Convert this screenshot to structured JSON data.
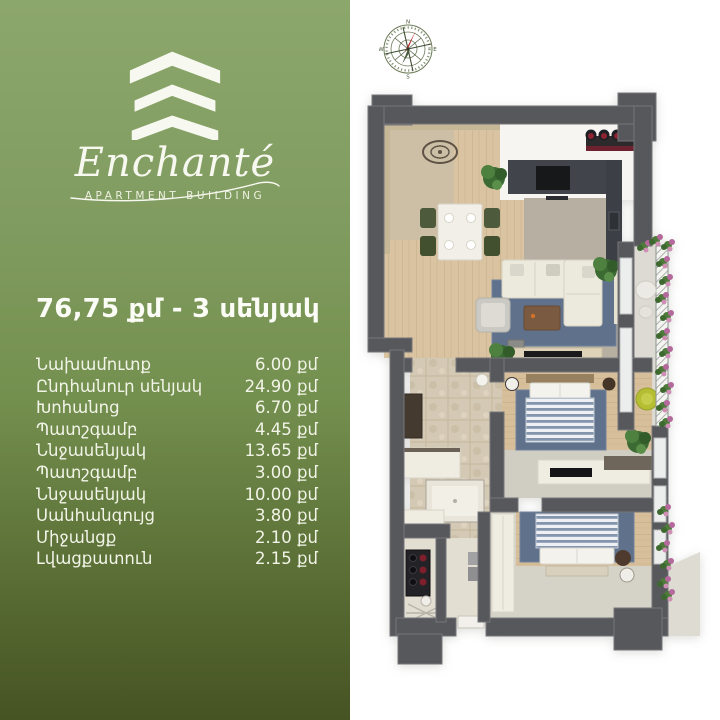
{
  "brand": {
    "name": "Enchanté",
    "tagline": "APARTMENT BUILDING",
    "logo_icon": "building-chevrons-icon"
  },
  "listing": {
    "title": "76,75 քմ - 3 սենյակ",
    "rooms": [
      {
        "label": "Նախամուտք",
        "area": "6.00 քմ"
      },
      {
        "label": "Ընդհանուր սենյակ",
        "area": "24.90 քմ"
      },
      {
        "label": "Խոհանոց",
        "area": "6.70 քմ"
      },
      {
        "label": "Պատշգամբ",
        "area": "4.45 քմ"
      },
      {
        "label": "Ննջասենյակ",
        "area": "13.65 քմ"
      },
      {
        "label": "Պատշգամբ",
        "area": "3.00 քմ"
      },
      {
        "label": "Ննջասենյակ",
        "area": "10.00 քմ"
      },
      {
        "label": "Սանհանգույց",
        "area": "3.80 քմ"
      },
      {
        "label": "Միջանցք",
        "area": "2.10 քմ"
      },
      {
        "label": "Լվացքատուն",
        "area": "2.15 քմ"
      }
    ]
  },
  "compass": {
    "n": "N",
    "e": "E",
    "s": "S",
    "w": "W"
  },
  "floorplan": {
    "view": "3d-top-down-apartment-render",
    "rooms": [
      "entry",
      "living-dining-room",
      "kitchen",
      "upper-balcony",
      "bedroom-1",
      "corridor",
      "bathroom",
      "laundry",
      "bedroom-2",
      "lower-balcony"
    ],
    "furniture": [
      "dining-table-4-chairs",
      "kitchen-counter",
      "bar-with-5-stools",
      "sectional-sofa",
      "blue-rug",
      "coffee-table",
      "armchair",
      "tv-console",
      "double-bed-1",
      "desk",
      "yellow-chair",
      "wardrobe",
      "shower",
      "washing-machine",
      "drying-rack",
      "double-bed-2",
      "closet",
      "plants",
      "flower-railing"
    ]
  },
  "colors": {
    "panel_gradient_top": "#8ca76c",
    "panel_gradient_bottom": "#465323",
    "text": "#f6f7ef",
    "wall": "#57585c",
    "wood_floor": "#d9c3a1",
    "tile_floor": "#d4c9b4",
    "concrete_floor": "#b7afa1",
    "rug_blue": "#5f718b",
    "accent_red": "#8c2331",
    "plant_green": "#4e8040",
    "chair_yellow": "#b5bd33"
  }
}
